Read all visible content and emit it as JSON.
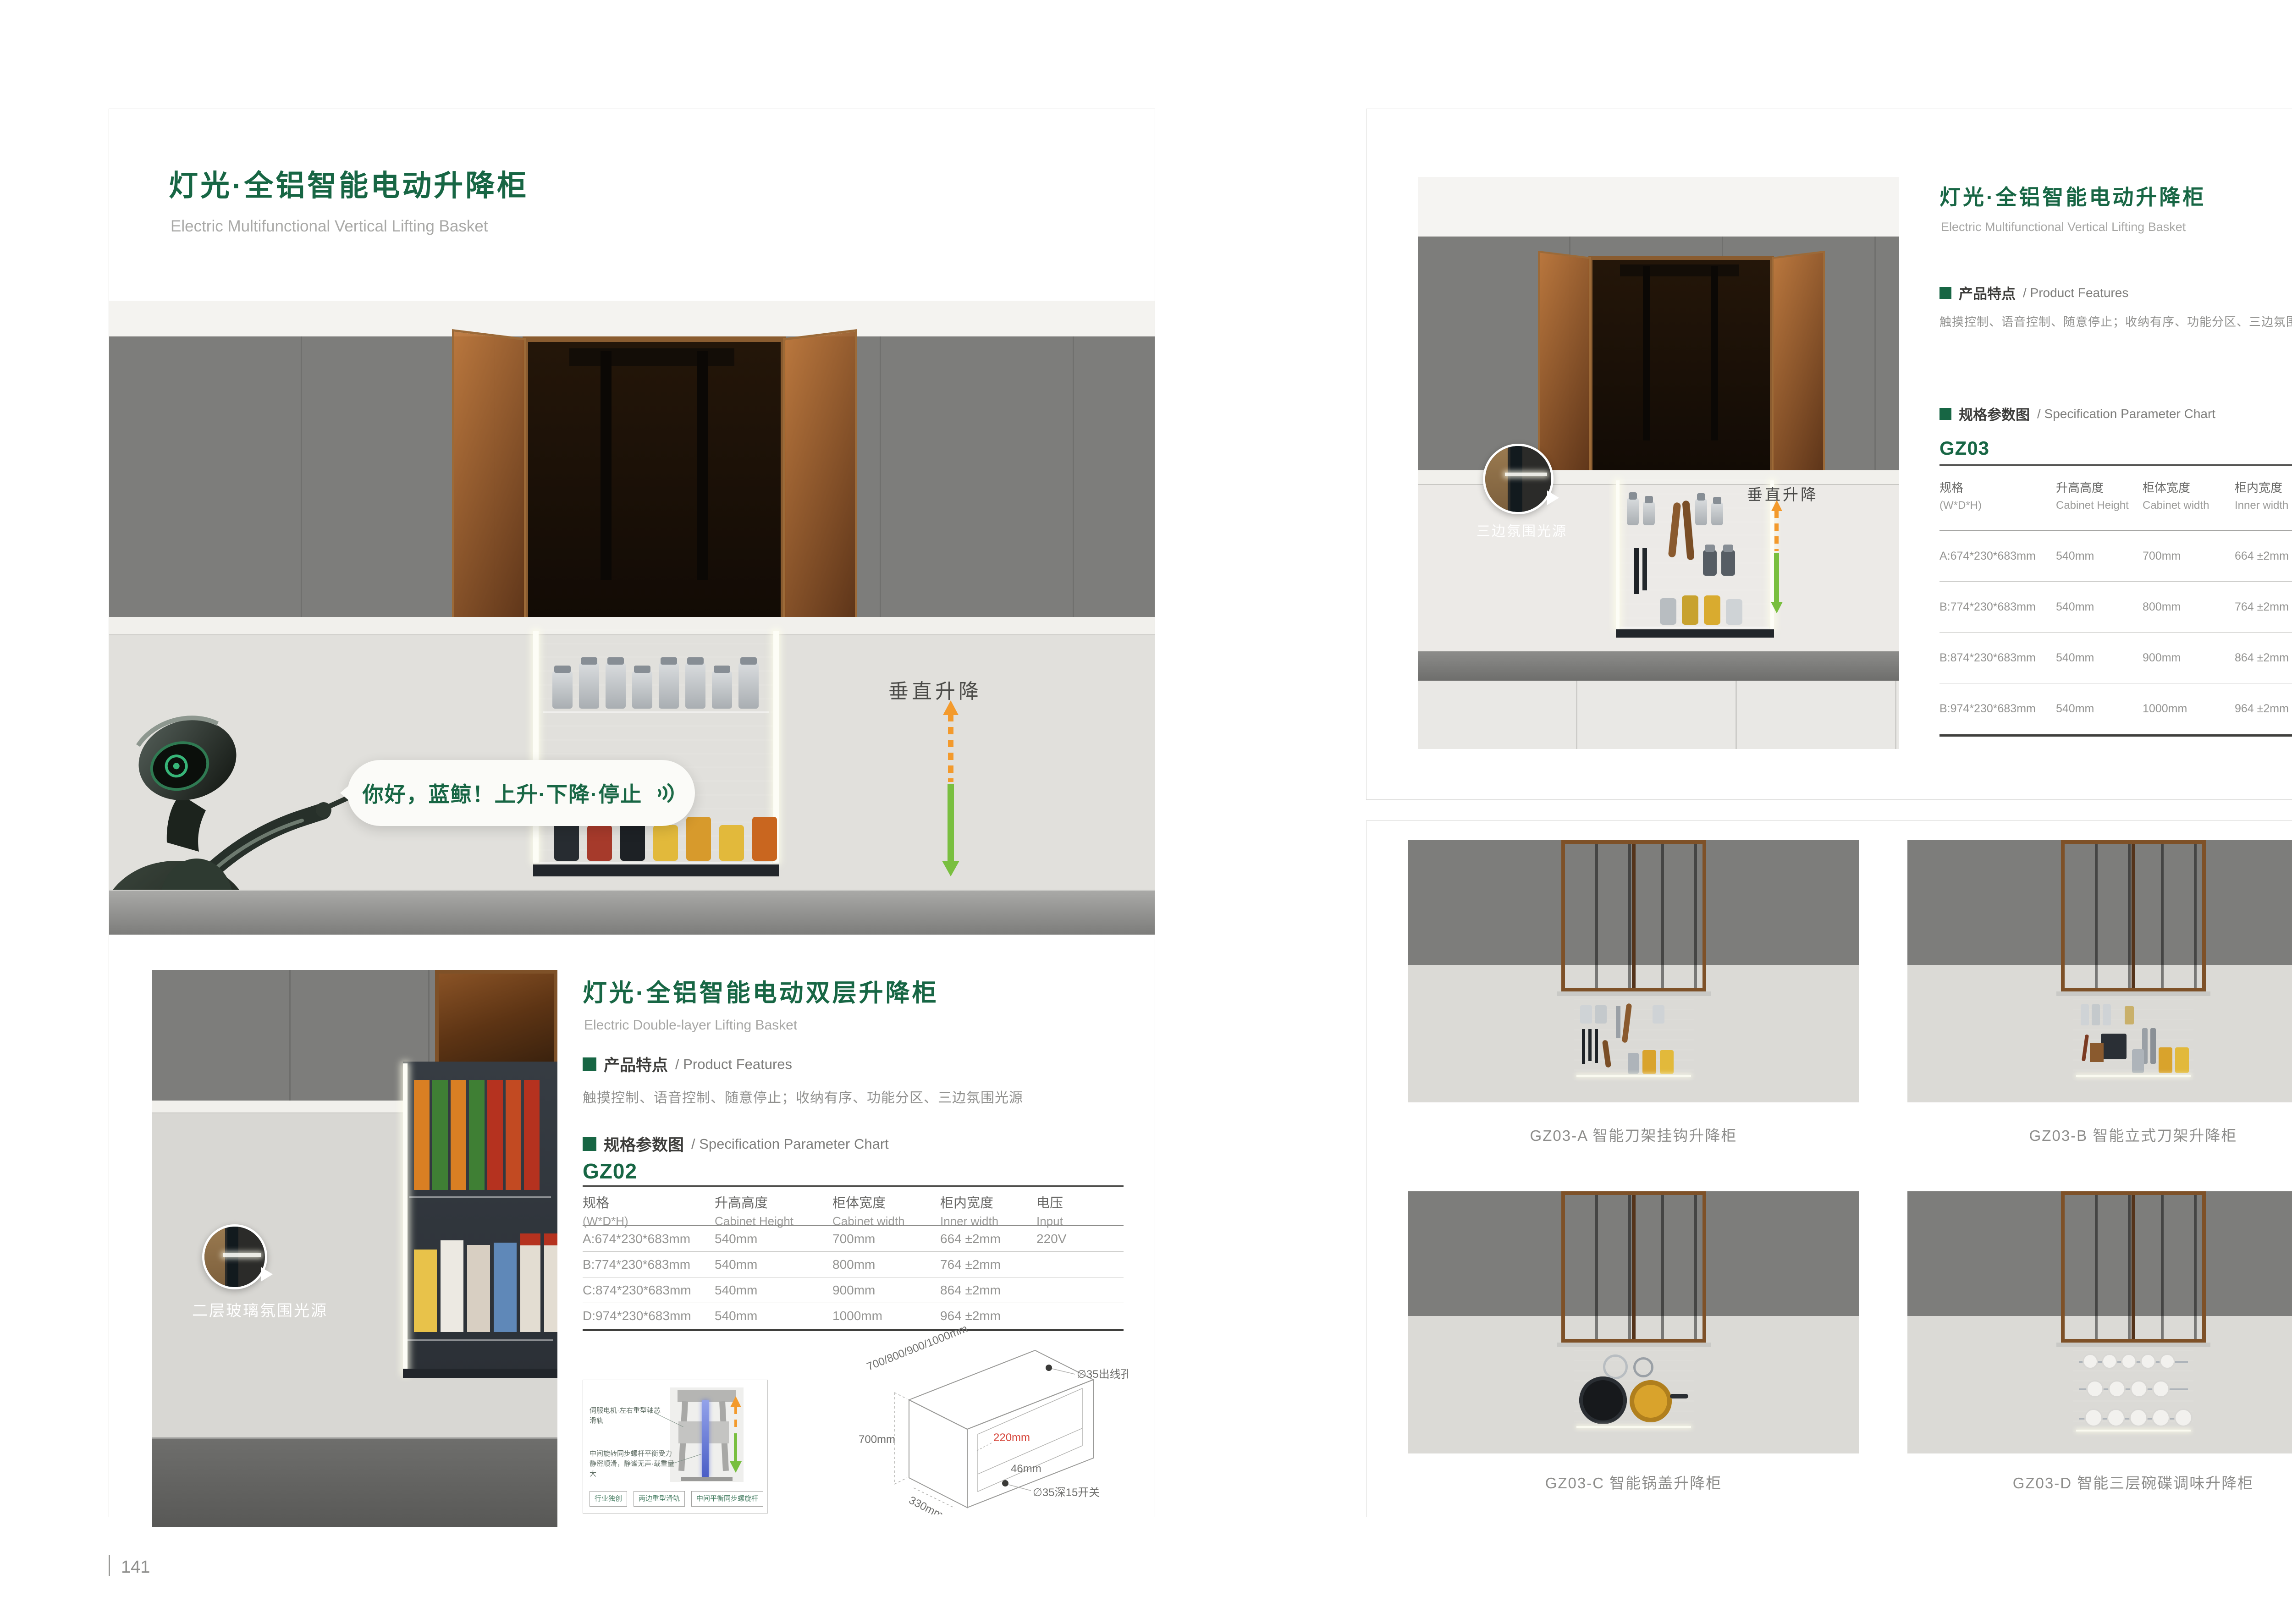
{
  "colors": {
    "accent": "#176644",
    "orange": "#f39a2c",
    "agreen": "#79bf3f",
    "dimred": "#d6453a"
  },
  "left": {
    "page_num": "141",
    "title_cn": "灯光·全铝智能电动升降柜",
    "title_en": "Electric Multifunctional Vertical Lifting Basket",
    "hero": {
      "speech": "你好，蓝鲸！上升·下降·停止",
      "lift_label": "垂直升降"
    },
    "thumb_label": "二层玻璃氛围光源",
    "sub": {
      "title_cn": "灯光·全铝智能电动双层升降柜",
      "title_en": "Electric Double-layer Lifting Basket",
      "features_cn": "产品特点",
      "features_en": "/ Product Features",
      "features_text": "触摸控制、语音控制、随意停止；收纳有序、功能分区、三边氛围光源",
      "spec_cn": "规格参数图",
      "spec_en": "/ Specification Parameter Chart",
      "model": "GZ02"
    },
    "table": {
      "headers": [
        {
          "cn": "规格",
          "en": "(W*D*H)"
        },
        {
          "cn": "升高高度",
          "en": "Cabinet Height"
        },
        {
          "cn": "柜体宽度",
          "en": "Cabinet width"
        },
        {
          "cn": "柜内宽度",
          "en": "Inner width"
        },
        {
          "cn": "电压",
          "en": "Input"
        }
      ],
      "rows": [
        [
          "A:674*230*683mm",
          "540mm",
          "700mm",
          "664 ±2mm",
          "220V"
        ],
        [
          "B:774*230*683mm",
          "540mm",
          "800mm",
          "764 ±2mm",
          ""
        ],
        [
          "C:874*230*683mm",
          "540mm",
          "900mm",
          "864 ±2mm",
          ""
        ],
        [
          "D:974*230*683mm",
          "540mm",
          "1000mm",
          "964 ±2mm",
          ""
        ]
      ]
    },
    "mech": {
      "label_top": "伺服电机·左右重型轴芯滑轨",
      "label_bottom_1": "中间旋转同步螺杆平衡受力",
      "label_bottom_2": "静密顺滑，静谧无声·载重量大",
      "tags": [
        "行业独创",
        "两边重型滑轨",
        "中间平衡同步螺旋杆"
      ]
    },
    "drawing": {
      "width_range": "700/800/900/1000mm",
      "hole": "∅35出线孔",
      "height": "700mm",
      "inner": "220mm",
      "gap": "46mm",
      "switch": "∅35深15开关",
      "depth": "330mm"
    }
  },
  "right": {
    "page_num": "142",
    "title_cn": "灯光·全铝智能电动升降柜",
    "title_en": "Electric Multifunctional Vertical Lifting Basket",
    "features_cn": "产品特点",
    "features_en": "/ Product Features",
    "features_text": "触摸控制、语音控制、随意停止；收纳有序、功能分区、三边氛围光源",
    "spec_cn": "规格参数图",
    "spec_en": "/ Specification Parameter Chart",
    "model": "GZ03",
    "photo": {
      "circle_label": "三边氛围光源",
      "lift_label": "垂直升降"
    },
    "table": {
      "headers": [
        {
          "cn": "规格",
          "en": "(W*D*H)"
        },
        {
          "cn": "升高高度",
          "en": "Cabinet Height"
        },
        {
          "cn": "柜体宽度",
          "en": "Cabinet width"
        },
        {
          "cn": "柜内宽度",
          "en": "Inner width"
        },
        {
          "cn": "电压",
          "en": "Input"
        }
      ],
      "rows": [
        [
          "A:674*230*683mm",
          "540mm",
          "700mm",
          "664 ±2mm",
          "220V"
        ],
        [
          "B:774*230*683mm",
          "540mm",
          "800mm",
          "764 ±2mm",
          ""
        ],
        [
          "B:874*230*683mm",
          "540mm",
          "900mm",
          "864 ±2mm",
          ""
        ],
        [
          "B:974*230*683mm",
          "540mm",
          "1000mm",
          "964 ±2mm",
          ""
        ]
      ]
    },
    "grid": [
      {
        "label": "GZ03-A 智能刀架挂钩升降柜"
      },
      {
        "label": "GZ03-B 智能立式刀架升降柜"
      },
      {
        "label": "GZ03-C 智能锅盖升降柜"
      },
      {
        "label": "GZ03-D 智能三层碗碟调味升降柜"
      }
    ]
  }
}
